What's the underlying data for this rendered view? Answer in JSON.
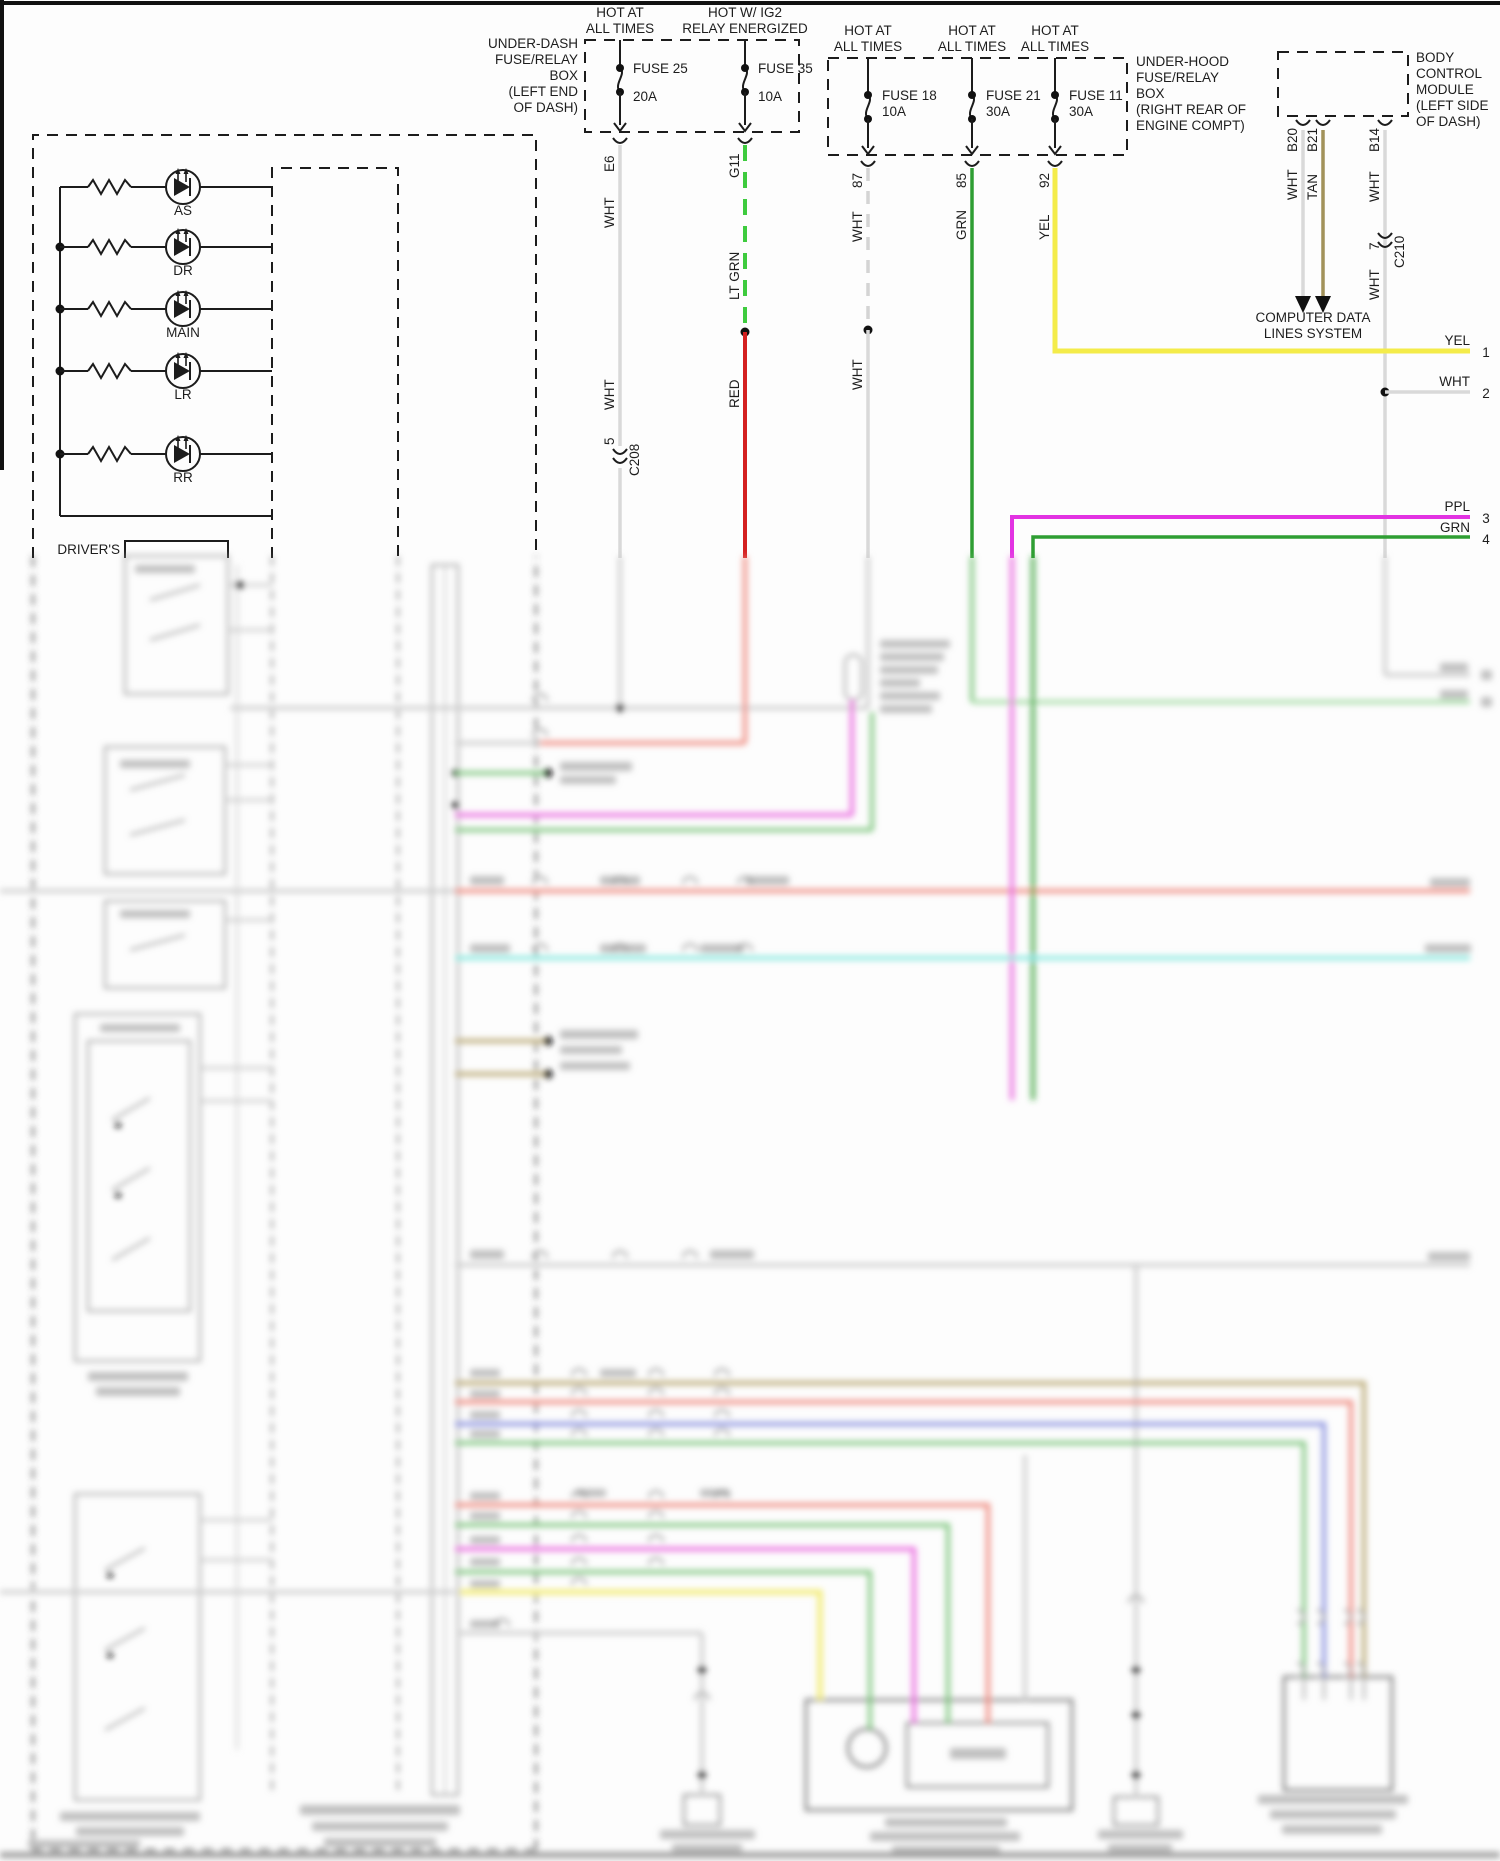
{
  "hot": {
    "a1": "HOT AT",
    "a2": "ALL TIMES",
    "b1": "HOT W/ IG2",
    "b2": "RELAY ENERGIZED"
  },
  "under_dash_box": {
    "l1": "UNDER-DASH",
    "l2": "FUSE/RELAY",
    "l3": "BOX",
    "l4": "(LEFT END",
    "l5": "OF DASH)"
  },
  "under_hood_box": {
    "l1": "UNDER-HOOD",
    "l2": "FUSE/RELAY",
    "l3": "BOX",
    "l4": "(RIGHT REAR OF",
    "l5": "ENGINE COMPT)"
  },
  "bcm": {
    "l1": "BODY",
    "l2": "CONTROL",
    "l3": "MODULE",
    "l4": "(LEFT SIDE",
    "l5": "OF DASH)"
  },
  "fuses": {
    "f25": {
      "name": "FUSE 25",
      "amps": "20A"
    },
    "f35": {
      "name": "FUSE 35",
      "amps": "10A"
    },
    "f18": {
      "name": "FUSE 18",
      "amps": "10A"
    },
    "f21": {
      "name": "FUSE 21",
      "amps": "30A"
    },
    "f11": {
      "name": "FUSE 11",
      "amps": "30A"
    }
  },
  "pins": {
    "e6": "E6",
    "g11": "G11",
    "p87": "87",
    "p85": "85",
    "p92": "92",
    "b20": "B20",
    "b21": "B21",
    "b14": "B14",
    "c208_pin": "5",
    "c208": "C208",
    "c210_pin": "7",
    "c210": "C210"
  },
  "wire_colors": {
    "wht": "WHT",
    "ltgrn": "LT GRN",
    "red": "RED",
    "grn": "GRN",
    "yel": "YEL",
    "tan": "TAN",
    "ppl": "PPL"
  },
  "destination": {
    "l1": "COMPUTER DATA",
    "l2": "LINES SYSTEM"
  },
  "terminals": {
    "t1c": "YEL",
    "t1n": "1",
    "t2c": "WHT",
    "t2n": "2",
    "t3c": "PPL",
    "t3n": "3",
    "t4c": "GRN",
    "t4n": "4"
  },
  "indicators": {
    "i1": "AS",
    "i2": "DR",
    "i3": "MAIN",
    "i4": "LR",
    "i5": "RR",
    "owner": "DRIVER'S"
  },
  "palette": {
    "black": "#1c1c1c",
    "white_wire": "#d9d9d9",
    "lt_green": "#3ecb3e",
    "red": "#d42020",
    "green": "#2f9e33",
    "yellow": "#f4ec4a",
    "tan": "#a2925a",
    "purple": "#e233e2",
    "blur_salmon": "#ef8b80",
    "blur_cyan": "#84e8df",
    "blur_khaki": "#b9a873",
    "blur_blue": "#8b93e0",
    "blur_green": "#6fbf6f",
    "blur_magenta": "#ea6ae0",
    "blur_yellow": "#f6f097",
    "blur_grey": "#c9c9c9"
  }
}
